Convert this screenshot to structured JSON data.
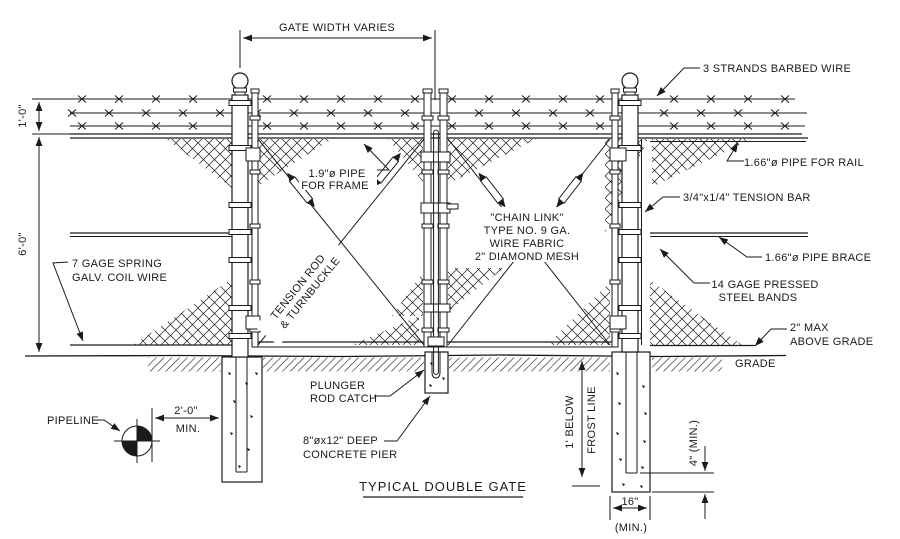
{
  "title": "TYPICAL DOUBLE GATE",
  "colors": {
    "line": "#1a1a1a",
    "background": "#ffffff"
  },
  "labels": {
    "barbed_wire": "3 STRANDS BARBED WIRE",
    "rail": "1.66\"ø PIPE FOR RAIL",
    "frame": [
      "1.9\"ø PIPE",
      "FOR FRAME"
    ],
    "chain_link": [
      "\"CHAIN LINK\"",
      "TYPE NO. 9 GA.",
      "WIRE FABRIC",
      "2\" DIAMOND MESH"
    ],
    "tension_bar": "3/4\"x1/4\" TENSION BAR",
    "brace": "1.66\"ø PIPE BRACE",
    "steel_bands": [
      "14 GAGE PRESSED",
      "STEEL BANDS"
    ],
    "above_grade": [
      "2\" MAX",
      "ABOVE GRADE"
    ],
    "grade": "GRADE",
    "coil_wire": [
      "7 GAGE SPRING",
      "GALV. COIL WIRE"
    ],
    "tension_rod": [
      "TENSION ROD",
      "& TURNBUCKLE"
    ],
    "plunger": [
      "PLUNGER",
      "ROD CATCH"
    ],
    "concrete_pier": [
      "8\"øx12\" DEEP",
      "CONCRETE PIER"
    ],
    "pipeline": "PIPELINE"
  },
  "dimensions": {
    "gate_width": "GATE WIDTH VARIES",
    "barbed_height": "1'-0\"",
    "fence_height": "6'-0\"",
    "pipeline_offset": "2'-0\"",
    "pipeline_offset_min": "MIN.",
    "frost": [
      "1' BELOW",
      "FROST LINE"
    ],
    "pier_embed": "4\" (MIN.)",
    "pier_width": "16\"",
    "pier_width_min": "(MIN.)"
  }
}
